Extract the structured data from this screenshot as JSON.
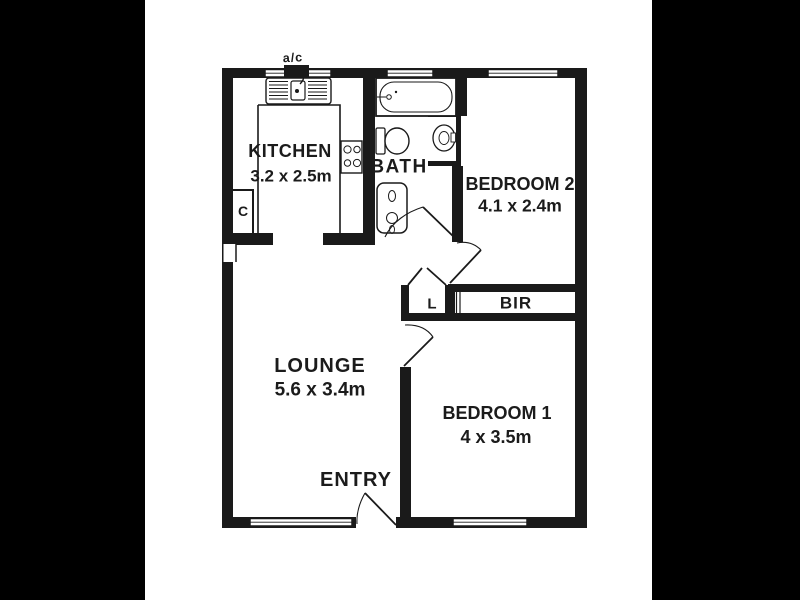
{
  "image": {
    "ac_label": "a/c",
    "colors": {
      "letterbox": "#000000",
      "paper": "#ffffff",
      "wall": "#1a1a1a",
      "text": "#1b1b1b"
    },
    "rooms": {
      "kitchen": {
        "name": "KITCHEN",
        "dims": "3.2 x 2.5m"
      },
      "bath": {
        "name": "BATH"
      },
      "bedroom2": {
        "name": "BEDROOM 2",
        "dims": "4.1 x 2.4m"
      },
      "bir": {
        "name": "BIR"
      },
      "linen": {
        "name": "L"
      },
      "cupboard": {
        "name": "C"
      },
      "lounge": {
        "name": "LOUNGE",
        "dims": "5.6 x 3.4m"
      },
      "entry": {
        "name": "ENTRY"
      },
      "bedroom1": {
        "name": "BEDROOM 1",
        "dims": "4 x 3.5m"
      }
    }
  }
}
